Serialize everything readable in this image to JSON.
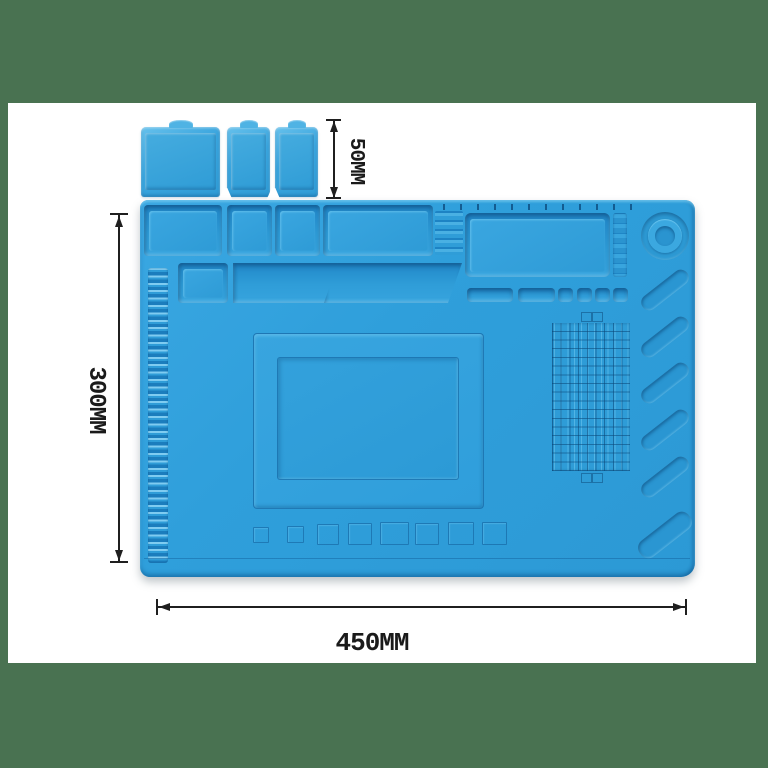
{
  "annotations": {
    "mat_width_label": "450MM",
    "mat_height_label": "300MM",
    "lid_height_label": "50MM"
  },
  "colors": {
    "backdrop_green": "#497251",
    "photo_background": "#FFFFFF",
    "mat_blue": "#2F9FDB",
    "mat_shadow_blue": "#1F86C6",
    "mat_highlight_blue": "#7FCCF1",
    "annotation_ink": "#1F1F1F"
  }
}
